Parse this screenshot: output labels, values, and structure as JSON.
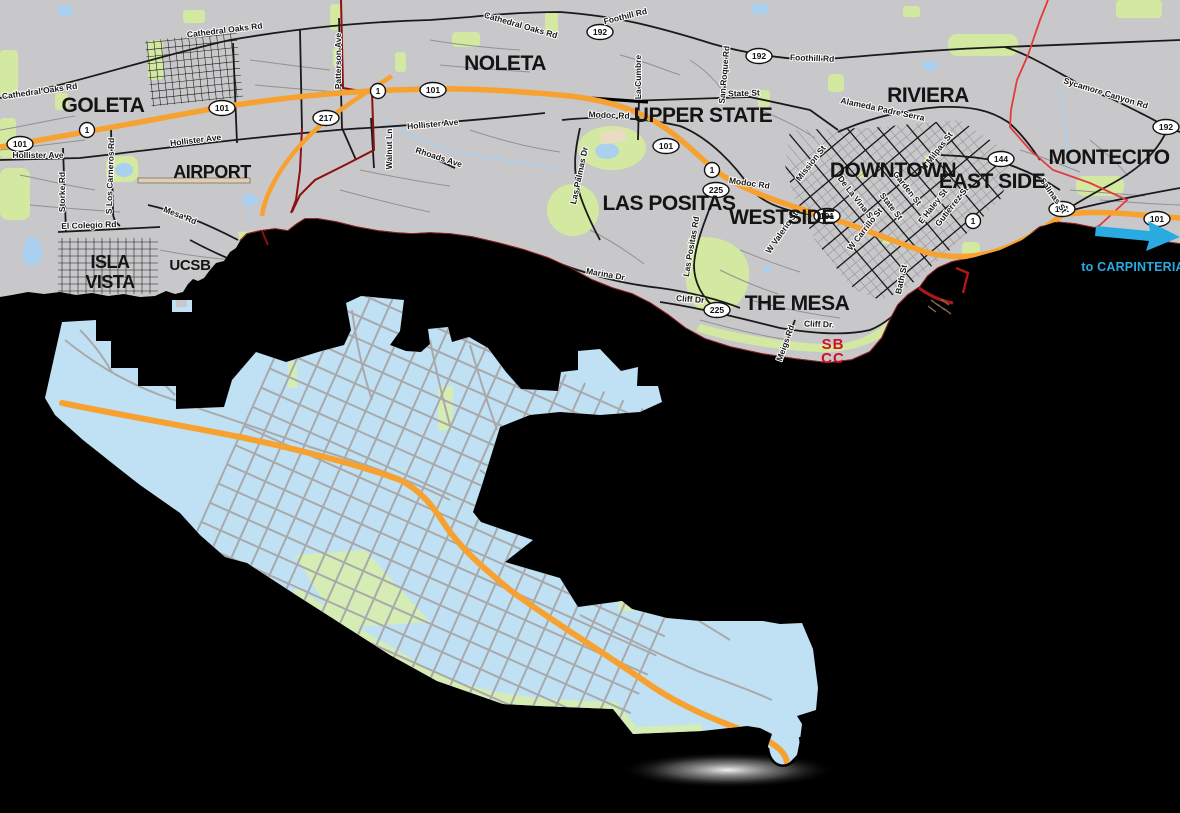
{
  "neighborhoods": [
    {
      "label": "GOLETA"
    },
    {
      "label": "NOLETA"
    },
    {
      "label": "UPPER STATE"
    },
    {
      "label": "RIVIERA"
    },
    {
      "label": "MONTECITO"
    },
    {
      "label": "AIRPORT"
    },
    {
      "line1": "ISLA",
      "line2": "VISTA"
    },
    {
      "label": "UCSB"
    },
    {
      "label": "LAS POSITAS"
    },
    {
      "label": "WESTSIDE"
    },
    {
      "label": "DOWNTOWN"
    },
    {
      "label": "EAST SIDE"
    },
    {
      "label": "THE MESA"
    }
  ],
  "campus": {
    "line1": "SB",
    "line2": "CC"
  },
  "direction": {
    "label": "to CARPINTERIA"
  },
  "roads": [
    {
      "name": "Cathedral Oaks Rd"
    },
    {
      "name": "Cathedral Oaks Rd"
    },
    {
      "name": "Cathedral Oaks Rd"
    },
    {
      "name": "Foothill Rd"
    },
    {
      "name": "Foothill Rd"
    },
    {
      "name": "Sycamore Canyon Rd"
    },
    {
      "name": "State St"
    },
    {
      "name": "La Cumbre"
    },
    {
      "name": "San Roque Rd"
    },
    {
      "name": "Modoc Rd"
    },
    {
      "name": "Modoc Rd"
    },
    {
      "name": "Hollister Ave"
    },
    {
      "name": "Hollister Ave"
    },
    {
      "name": "Hollister Ave"
    },
    {
      "name": "Storke Rd"
    },
    {
      "name": "S Los Carneros Rd"
    },
    {
      "name": "El Colegio Rd"
    },
    {
      "name": "Mesa Rd"
    },
    {
      "name": "Walnut Ln"
    },
    {
      "name": "Rhoads Ave"
    },
    {
      "name": "Las Palmas Dr"
    },
    {
      "name": "Marina Dr"
    },
    {
      "name": "Las Positas Rd"
    },
    {
      "name": "W Valerio St"
    },
    {
      "name": "Cliff Dr"
    },
    {
      "name": "Cliff Dr."
    },
    {
      "name": "Meigs Rd"
    },
    {
      "name": "Alameda Padre Serra"
    },
    {
      "name": "Mission St"
    },
    {
      "name": "De La Vina St"
    },
    {
      "name": "State St"
    },
    {
      "name": "Garden St"
    },
    {
      "name": "W Carrillo St"
    },
    {
      "name": "E Haley St"
    },
    {
      "name": "Gutierrez St"
    },
    {
      "name": "N Milpas St"
    },
    {
      "name": "Salinas St"
    },
    {
      "name": "Bath St"
    },
    {
      "name": "Patterson Ave"
    }
  ],
  "shields": [
    {
      "route": "101"
    },
    {
      "route": "1"
    },
    {
      "route": "101"
    },
    {
      "route": "217"
    },
    {
      "route": "1"
    },
    {
      "route": "101"
    },
    {
      "route": "192"
    },
    {
      "route": "192"
    },
    {
      "route": "101"
    },
    {
      "route": "1"
    },
    {
      "route": "225"
    },
    {
      "route": "225"
    },
    {
      "route": "101"
    },
    {
      "route": "1"
    },
    {
      "route": "144"
    },
    {
      "route": "101"
    },
    {
      "route": "101"
    },
    {
      "route": "192"
    }
  ],
  "colors": {
    "land": "#C8C8CA",
    "ocean": "#000000",
    "freeway_orange": "#F7A230",
    "park_green": "#D3E8A0",
    "water_blue": "#A9D0EF",
    "inset_blue": "#BFE1F3",
    "inset_street_gray": "#A9A9AC",
    "boundary_red": "#E23B3A",
    "boundary_dark_red": "#8F1010",
    "sbcc_red": "#CE1126",
    "carpinteria_cyan": "#29ABE2"
  }
}
